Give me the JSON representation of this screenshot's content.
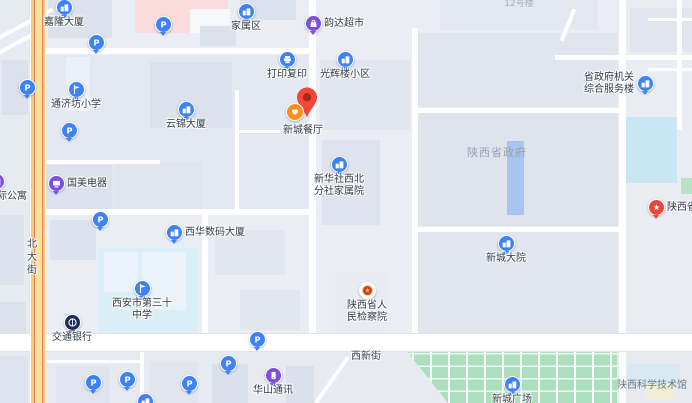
{
  "map": {
    "selected_poi": {
      "label": "新城餐厅",
      "x": 307,
      "y": 117
    },
    "area_labels": [
      {
        "id": "shaanxi-provincial-government",
        "text": "陕西省政府",
        "x": 497,
        "y": 150
      },
      {
        "id": "shaanxi-science-museum",
        "text": "陕西科学技术馆",
        "x": 652,
        "y": 382
      },
      {
        "id": "building-12",
        "text": "12号楼",
        "x": 519,
        "y": 2
      }
    ],
    "road_labels": [
      {
        "id": "beidajie",
        "text": "北大街",
        "x": 29,
        "y": 238
      },
      {
        "id": "xixinjie",
        "text": "西新街",
        "x": 366,
        "y": 353
      }
    ],
    "marker_colors": {
      "blue": "#3E82F7",
      "purple": "#7D4FDE",
      "navy": "#1E2B5C",
      "red": "#E8473D",
      "orange": "#FF8F1F",
      "white": "#FFFFFF"
    },
    "map_colors": {
      "background": "#EAEDF3",
      "building": "#DCE2EC",
      "school_grounds": "#D9EEF6",
      "water_pool": "#C9E7F3",
      "plaza_green": "#ABDFBD",
      "main_road_yellow": "#F8DE8E",
      "pink_building": "#FADCDC",
      "gov_building_blue": "#A6C6F1"
    },
    "pois": [
      {
        "id": "jialong-tower",
        "type": "building",
        "color": "blue",
        "x": 64,
        "y": 7,
        "pos": "below",
        "label": "嘉隆大厦"
      },
      {
        "id": "family-district",
        "type": "building",
        "color": "blue",
        "x": 246,
        "y": 11,
        "pos": "below",
        "label": "家属区"
      },
      {
        "id": "yunda-supermarket",
        "type": "bag",
        "color": "purple",
        "x": 313,
        "y": 23,
        "pos": "right",
        "label": "韵达超市"
      },
      {
        "id": "print-copy-shop",
        "type": "print",
        "color": "blue",
        "x": 287,
        "y": 59,
        "pos": "below",
        "label": "打印复印"
      },
      {
        "id": "guanghui-community",
        "type": "building",
        "color": "blue",
        "x": 345,
        "y": 59,
        "pos": "below",
        "label": "光辉楼小区"
      },
      {
        "id": "tongjifang-primary-school",
        "type": "school",
        "color": "blue",
        "x": 76,
        "y": 89,
        "pos": "below",
        "label": "通济坊小学"
      },
      {
        "id": "yunjin-tower",
        "type": "building",
        "color": "blue",
        "x": 186,
        "y": 109,
        "pos": "below",
        "label": "云锦大厦"
      },
      {
        "id": "xinhua-branch-dormitory",
        "type": "building",
        "color": "blue",
        "x": 339,
        "y": 164,
        "pos": "below",
        "label": "新华社西北分社家属院",
        "lines": [
          "新华社西北",
          "分社家属院"
        ]
      },
      {
        "id": "gome-electronics",
        "type": "tv",
        "color": "purple",
        "x": 56,
        "y": 183,
        "pos": "right",
        "label": "国美电器"
      },
      {
        "id": "ji-apartment",
        "type": "building",
        "color": "purple",
        "x": -4,
        "y": 181,
        "pos": "below",
        "label": "际公寓",
        "label_dx": 16
      },
      {
        "id": "xihua-digital-tower",
        "type": "building",
        "color": "blue",
        "x": 174,
        "y": 232,
        "pos": "right",
        "label": "西华数码大厦"
      },
      {
        "id": "xian-no30-middle-school",
        "type": "school",
        "color": "blue",
        "x": 142,
        "y": 288,
        "pos": "below",
        "label": "西安市第三十中学",
        "lines": [
          "西安市第三十",
          "中学"
        ]
      },
      {
        "id": "xincheng-compound",
        "type": "building",
        "color": "blue",
        "x": 506,
        "y": 243,
        "pos": "below",
        "label": "新城大院"
      },
      {
        "id": "gov-service-building",
        "type": "building",
        "color": "blue",
        "x": 645,
        "y": 83,
        "pos": "left",
        "label": "省政府机关综合服务楼",
        "lines": [
          "省政府机关",
          "综合服务楼"
        ]
      },
      {
        "id": "bank-of-communications",
        "type": "bank",
        "color": "navy",
        "x": 72,
        "y": 322,
        "pos": "below",
        "label": "交通银行"
      },
      {
        "id": "shaanxi-procuratorate",
        "type": "emblem",
        "color": "white",
        "x": 367,
        "y": 290,
        "pos": "below",
        "label": "陕西省人民检察院",
        "lines": [
          "陕西省人",
          "民检察院"
        ]
      },
      {
        "id": "shaanxi-partial-right-edge",
        "type": "star",
        "color": "red",
        "x": 656,
        "y": 207,
        "pos": "right",
        "label": "陕西省"
      },
      {
        "id": "huashan-telecom",
        "type": "phone",
        "color": "purple",
        "x": 273,
        "y": 375,
        "pos": "below",
        "label": "华山通讯"
      },
      {
        "id": "xincheng-square",
        "type": "building",
        "color": "blue",
        "x": 512,
        "y": 384,
        "pos": "below",
        "label": "新城广场"
      },
      {
        "id": "bottom-edge-poi",
        "type": "building",
        "color": "blue",
        "x": 145,
        "y": 401,
        "pos": "below",
        "label": ""
      },
      {
        "id": "parking-1",
        "type": "parking",
        "color": "blue",
        "x": 163,
        "y": 24,
        "label": ""
      },
      {
        "id": "parking-2",
        "type": "parking",
        "color": "blue",
        "x": 96,
        "y": 42,
        "label": ""
      },
      {
        "id": "parking-3",
        "type": "parking",
        "color": "blue",
        "x": 27,
        "y": 87,
        "label": ""
      },
      {
        "id": "parking-4",
        "type": "parking",
        "color": "blue",
        "x": 69,
        "y": 130,
        "label": ""
      },
      {
        "id": "parking-5",
        "type": "parking",
        "color": "blue",
        "x": 100,
        "y": 219,
        "label": ""
      },
      {
        "id": "parking-6",
        "type": "parking",
        "color": "blue",
        "x": 257,
        "y": 339,
        "label": ""
      },
      {
        "id": "parking-7",
        "type": "parking",
        "color": "blue",
        "x": 228,
        "y": 363,
        "label": ""
      },
      {
        "id": "parking-8",
        "type": "parking",
        "color": "blue",
        "x": 127,
        "y": 379,
        "label": ""
      },
      {
        "id": "parking-9",
        "type": "parking",
        "color": "blue",
        "x": 93,
        "y": 382,
        "label": ""
      },
      {
        "id": "parking-10",
        "type": "parking",
        "color": "blue",
        "x": 189,
        "y": 383,
        "label": ""
      }
    ]
  }
}
